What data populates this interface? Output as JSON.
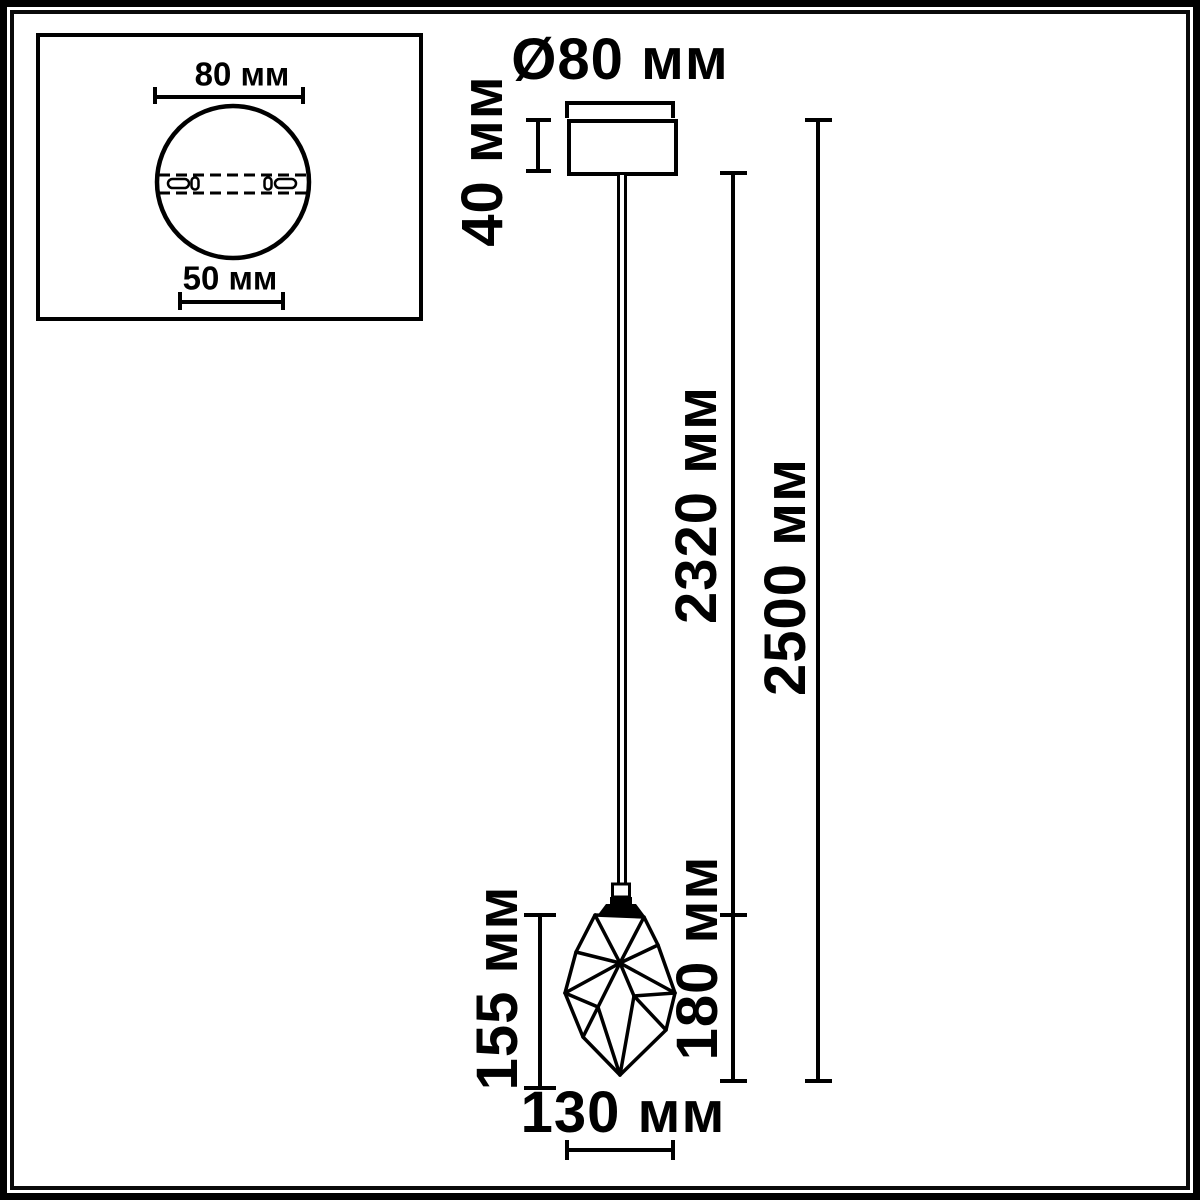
{
  "colors": {
    "line": "#000000",
    "background": "#ffffff"
  },
  "inset": {
    "width_top": "80 мм",
    "width_bottom": "50 мм"
  },
  "pendant": {
    "canopy_diameter": "Ø80 мм",
    "canopy_height": "40 мм",
    "cord_length": "2320 мм",
    "total_height": "2500 мм",
    "shade_height_left": "155 мм",
    "shade_height_right": "180 мм",
    "shade_width": "130 мм"
  }
}
